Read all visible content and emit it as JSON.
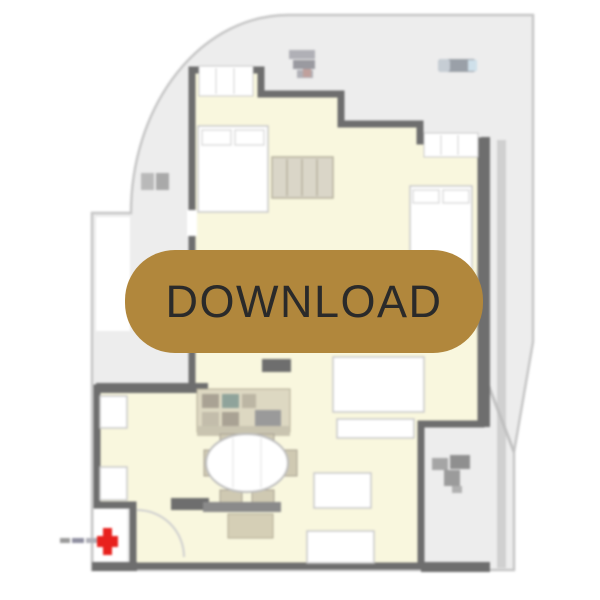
{
  "download_button": {
    "label": "DOWNLOAD",
    "background_color": "#b1873c",
    "label_color": "#2a2a2a"
  },
  "floor_plan": {
    "type": "apartment-floor-plan-image",
    "colors": {
      "page_background": "#ffffff",
      "terrace_fill": "#ededed",
      "terrace_border": "#c6c6c6",
      "room_fill": "#f9f7de",
      "wall": "#6e6e6e",
      "furniture_fill": "#ffffff",
      "furniture_outline": "#c9c9c9",
      "counter_fill": "#ddd8c2",
      "counter_accent": "#a9a294",
      "wood_accent": "#d5cfb6",
      "entrance_marker_red": "#e8211d",
      "symbol_gray": "#9a9aa0"
    },
    "icons": [
      "entrance-marker-icon",
      "compass-symbol-icon",
      "terrace-label",
      "dimension-label",
      "terrace-plant-icon"
    ]
  }
}
